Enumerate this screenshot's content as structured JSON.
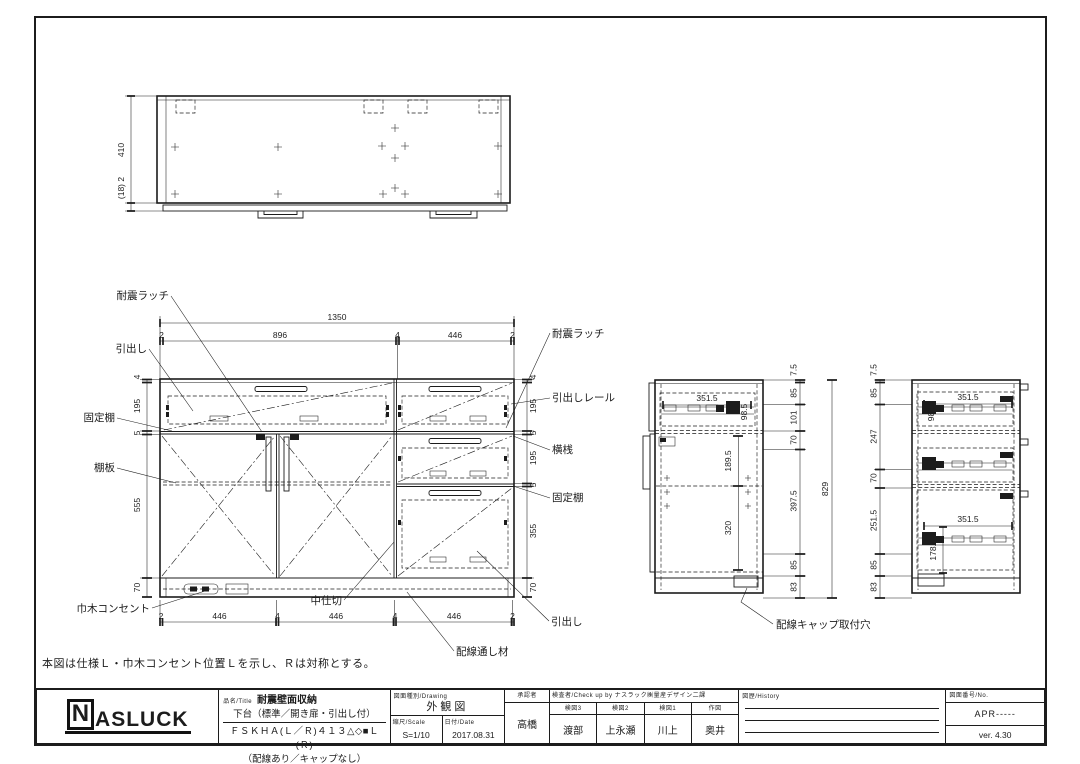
{
  "note": "本図は仕様Ｌ・巾木コンセント位置Ｌを示し、Ｒは対称とする。",
  "top_view": {
    "height_dim": "410",
    "thickness_dim": "(18) 2"
  },
  "front_view": {
    "total_width": "1350",
    "top_dims": [
      "2",
      "896",
      "4",
      "446",
      "2"
    ],
    "left_dims": [
      "4",
      "195",
      "5",
      "555",
      "70"
    ],
    "right_dims": [
      "4",
      "195",
      "5",
      "195",
      "5",
      "355",
      "70"
    ],
    "bottom_dims": [
      "2",
      "446",
      "4",
      "446",
      "4",
      "446",
      "2"
    ],
    "labels": {
      "taishin_latch_left": "耐震ラッチ",
      "drawer_left": "引出し",
      "fixed_shelf_left": "固定棚",
      "shelf_board": "棚板",
      "baseboard_outlet": "巾木コンセント",
      "taishin_latch_right": "耐震ラッチ",
      "drawer_rail": "引出しレール",
      "cross_rail": "横桟",
      "fixed_shelf_right": "固定棚",
      "drawer_right": "引出し",
      "center_divider": "中仕切",
      "wiring_pass": "配線通し材"
    }
  },
  "side_view_left": {
    "right_dims": [
      "7.5",
      "85",
      "101",
      "70",
      "397.5",
      "85",
      "83"
    ],
    "total_height": "829",
    "rail_width": "351.5",
    "rail_height": "98.5",
    "shelf_offset": "189.5",
    "bottom_offset": "320",
    "cap_label": "配線キャップ取付穴"
  },
  "side_view_right": {
    "left_dims": [
      "7.5",
      "85",
      "247",
      "70",
      "251.5",
      "85",
      "83"
    ],
    "rail_width_top": "351.5",
    "rail_height_top": "98.5",
    "rail_width_bottom": "351.5",
    "rail_height_bottom": "178.5"
  },
  "title_block": {
    "logo_n": "N",
    "logo_rest": "ASLUCK",
    "name_label": "品名/Title",
    "product_line1": "耐震壁面収納",
    "product_line2": "下台（標準／開き扉・引出し付）",
    "product_line3": "ＦＳＫＨＡ(Ｌ／Ｒ)４１３△◇■Ｌ(Ｒ)",
    "product_line4": "（配線あり／キャップなし）",
    "drawing_label": "図面種別/Drawing",
    "drawing_type": "外観図",
    "scale_label": "縮尺/Scale",
    "scale_value": "S=1/10",
    "date_label": "日付/Date",
    "date_value": "2017.08.31",
    "approver_label": "承認者",
    "approver_name": "高橋",
    "check_header": "検査者/Check up by ナスラック㈱量産デザイン二課",
    "checks": [
      {
        "label": "検図3",
        "name": "渡部"
      },
      {
        "label": "検図2",
        "name": "上永瀬"
      },
      {
        "label": "検図1",
        "name": "川上"
      },
      {
        "label": "作図",
        "name": "奥井"
      }
    ],
    "history_label": "図歴/History",
    "number_label": "図面番号/No.",
    "number_value": "APR-----",
    "version": "ver. 4.30"
  }
}
